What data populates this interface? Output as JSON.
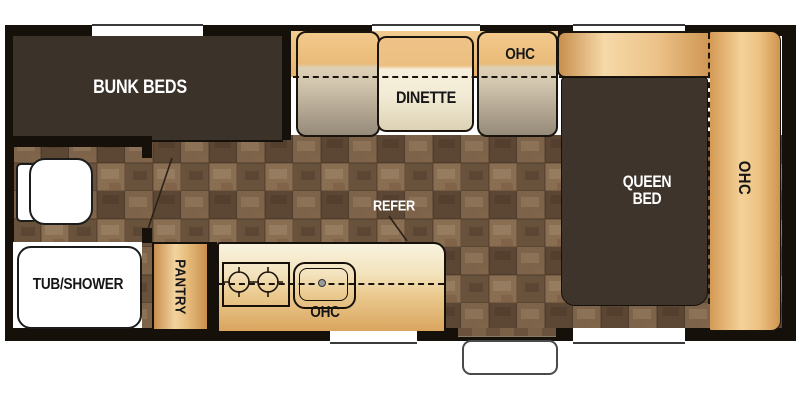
{
  "floorplan": {
    "title": "travel trailer floor plan",
    "rooms": {
      "bunk_beds": {
        "label": "BUNK BEDS"
      },
      "dinette": {
        "label": "DINETTE"
      },
      "dinette_ohc": {
        "label": "OHC"
      },
      "queen_bed": {
        "label": "QUEEN BED"
      },
      "queen_ohc": {
        "label": "OHC"
      },
      "refer": {
        "label": "REFER"
      },
      "kitchen_ohc": {
        "label": "OHC"
      },
      "pantry": {
        "label": "PANTRY"
      },
      "tub_shower": {
        "label": "TUB/SHOWER"
      }
    },
    "colors": {
      "wall": "#15100a",
      "dark_furniture": "#3b322a",
      "gold_light": "#f5d9a8",
      "gold_mid": "#e8b873",
      "gold_dark": "#c98f4e",
      "carpet_base": "#6f5740",
      "bench_grey": "#968b79",
      "cream": "#f6efdc",
      "fixture_white": "#ffffff"
    }
  }
}
